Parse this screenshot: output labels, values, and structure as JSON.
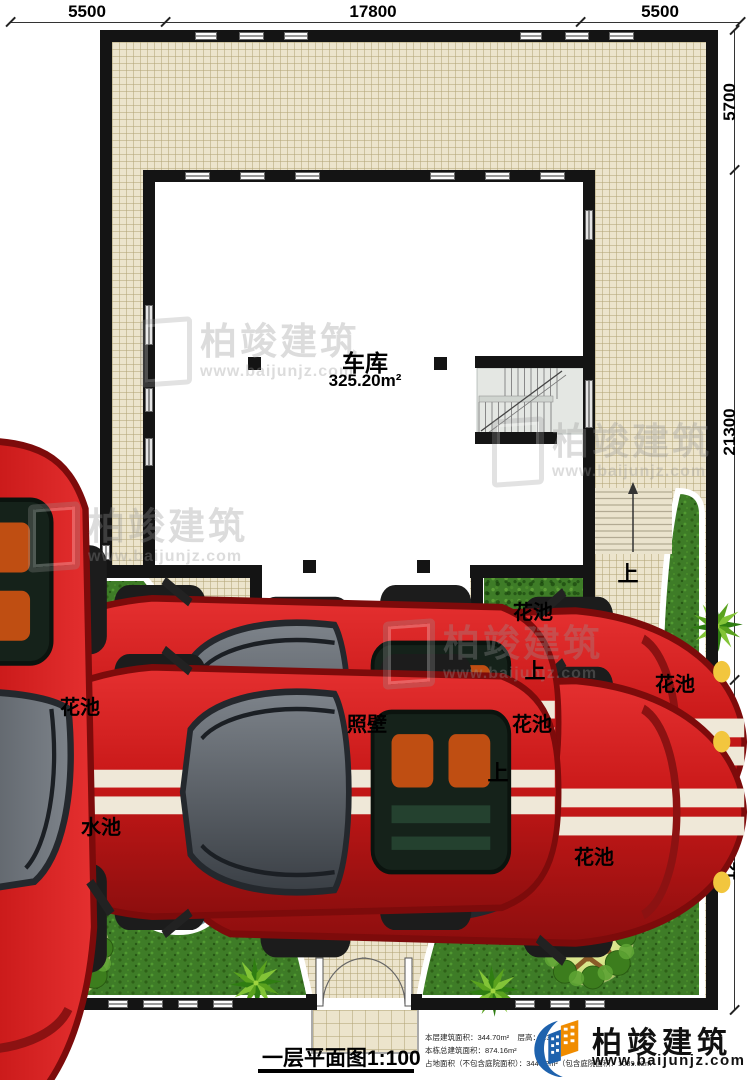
{
  "annotations": {
    "dim_top": [
      "5500",
      "17800",
      "5500"
    ],
    "dim_right": [
      "5700",
      "21300",
      "12900"
    ]
  },
  "rooms": {
    "garage_label": "车库",
    "garage_area": "325.20m²",
    "screen_wall": "照壁"
  },
  "landscape": {
    "flower_bed": "花池",
    "water_pool": "水池",
    "up": "上"
  },
  "titleblock": {
    "title": "一层平面图1:100",
    "stat_floor_area": "本层建筑面积：344.70m²",
    "stat_floor_height": "层高：3.3m",
    "stat_total_area": "本栋总建筑面积：874.16m²",
    "stat_footprint": "占地面积（不包含庭院面积）：344.72m²（包含庭院面积：1089.02m²"
  },
  "brand": {
    "name": "柏竣建筑",
    "website": "www.baijunjz.com"
  },
  "watermark": {
    "name": "柏竣建筑",
    "website": "www.baijunjz.com"
  },
  "colors": {
    "tile": "#ece4cc",
    "grass": "#3e7c27",
    "wall": "#141414",
    "car_red": "#c81818",
    "pool_water": "#6fd4e8",
    "logo_blue": "#1e62ad",
    "logo_orange": "#f08c00"
  }
}
